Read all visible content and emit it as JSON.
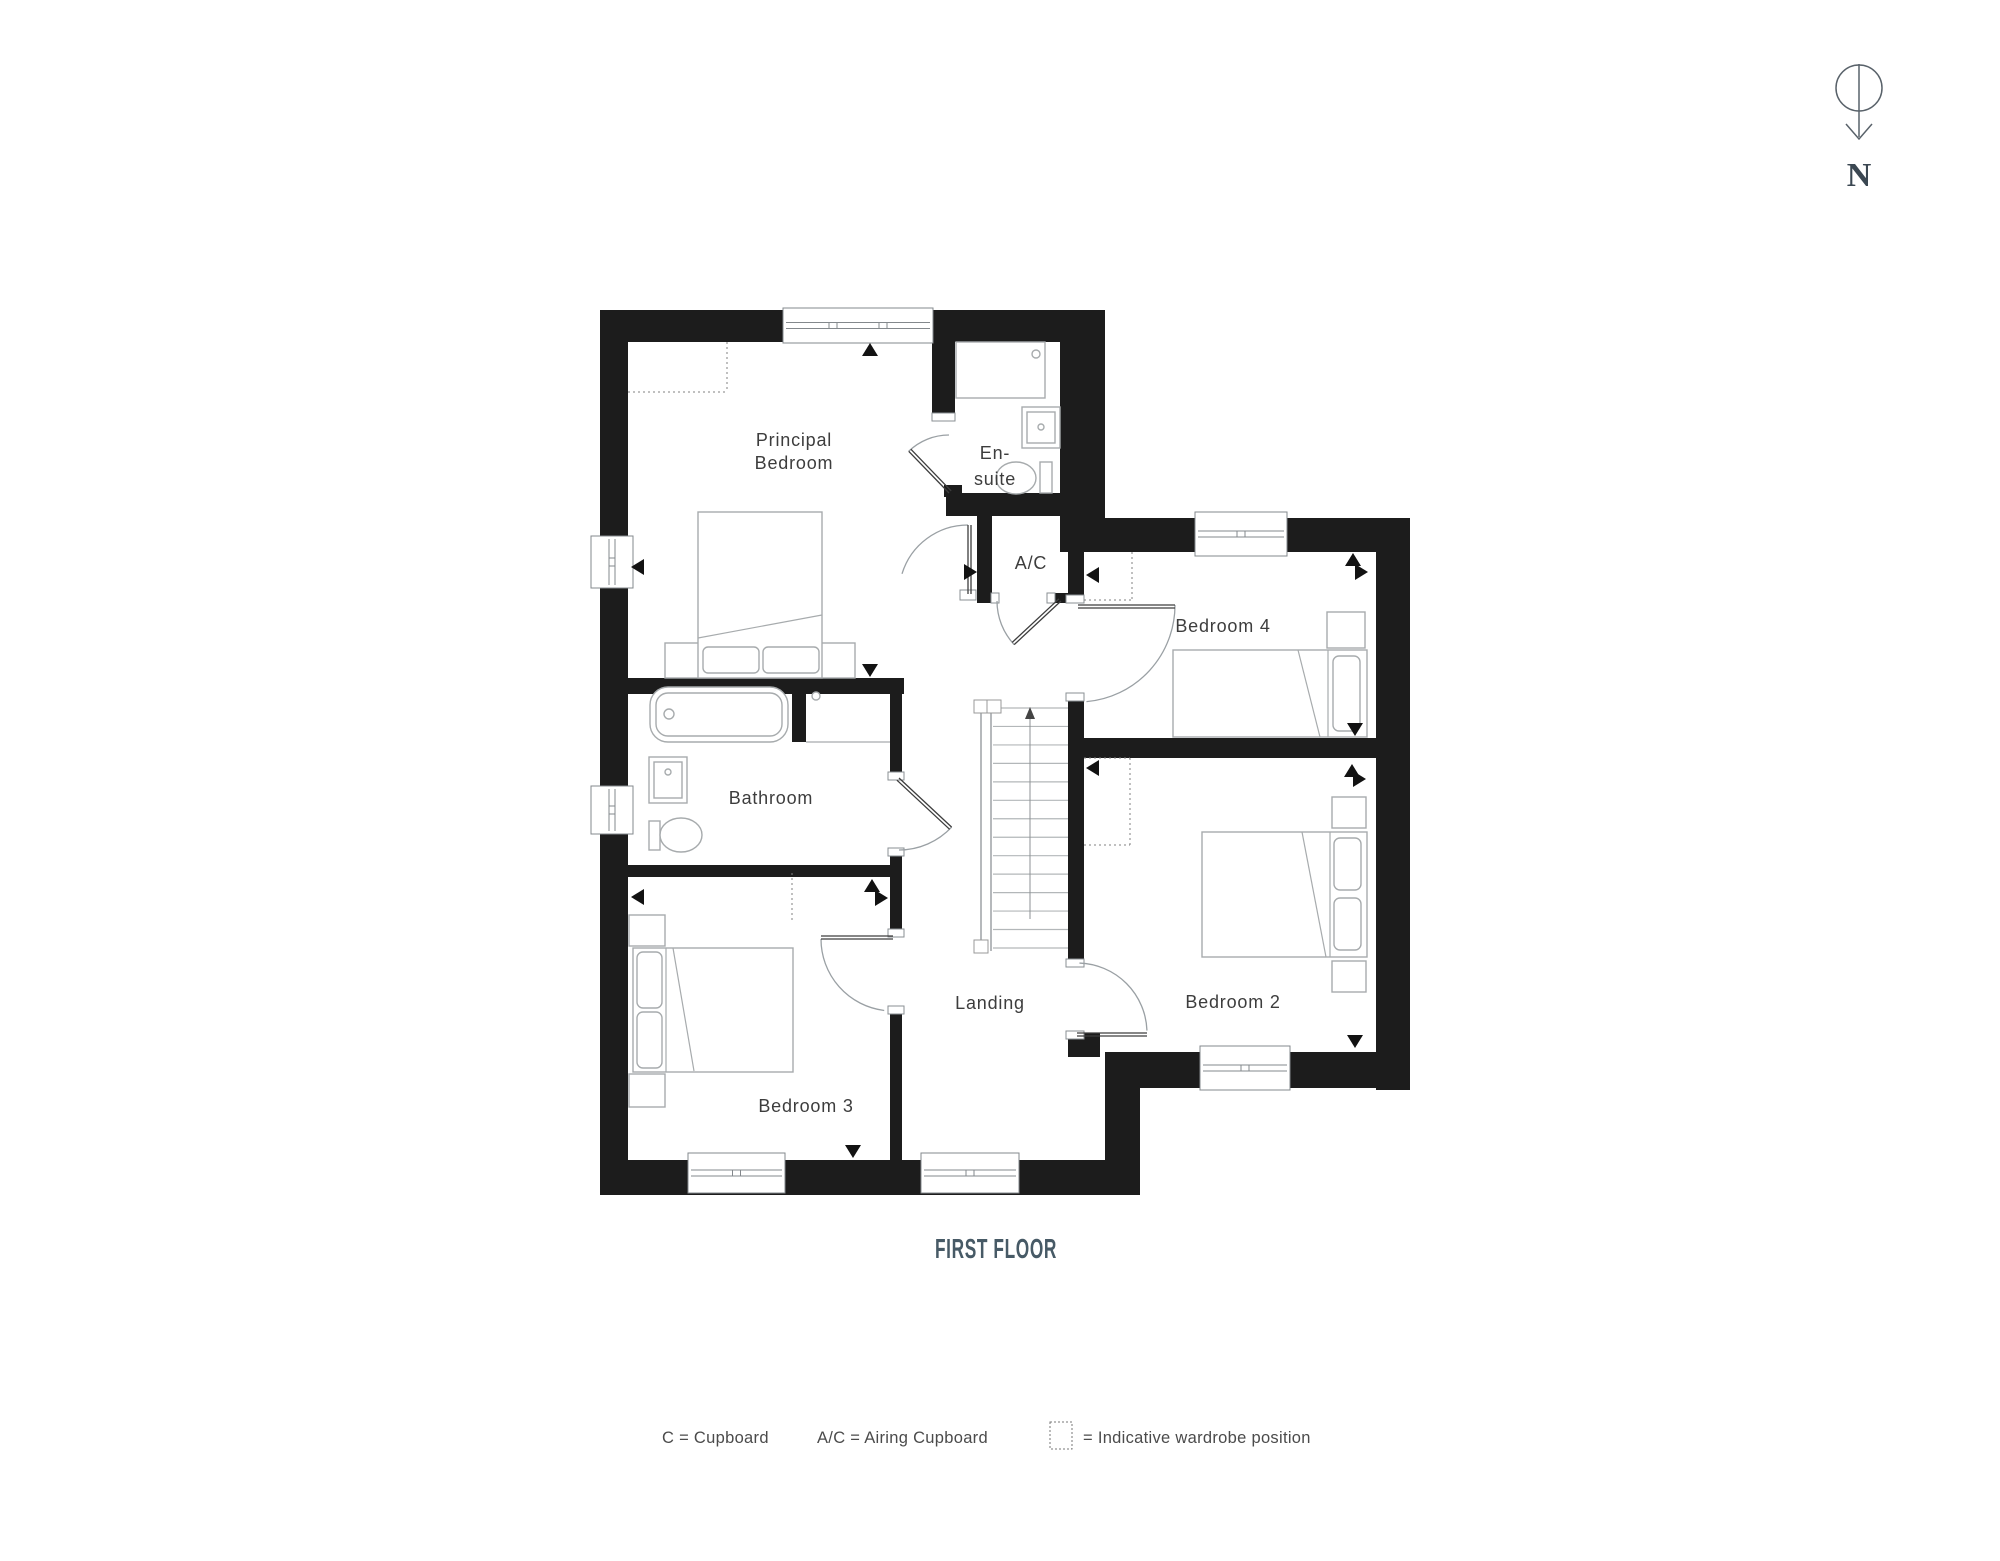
{
  "title": "FIRST FLOOR",
  "compass": {
    "label": "N"
  },
  "rooms": {
    "principal": {
      "label": "Principal Bedroom",
      "line1": "Principal",
      "line2": "Bedroom"
    },
    "ensuite": {
      "label": "En-suite",
      "line1": "En-",
      "line2": "suite"
    },
    "ac": {
      "label": "A/C"
    },
    "bedroom4": {
      "label": "Bedroom 4"
    },
    "bathroom": {
      "label": "Bathroom"
    },
    "bedroom2": {
      "label": "Bedroom 2"
    },
    "bedroom3": {
      "label": "Bedroom 3"
    },
    "landing": {
      "label": "Landing"
    }
  },
  "legend": {
    "cupboard": "C = Cupboard",
    "airing_cupboard": "A/C = Airing Cupboard",
    "wardrobe": "= Indicative wardrobe position"
  },
  "colors": {
    "wall": "#1c1c1c",
    "furniture_line": "#a7abad",
    "door_arc": "#9aa0a4",
    "text": "#3d3d3d",
    "title": "#475a66"
  }
}
